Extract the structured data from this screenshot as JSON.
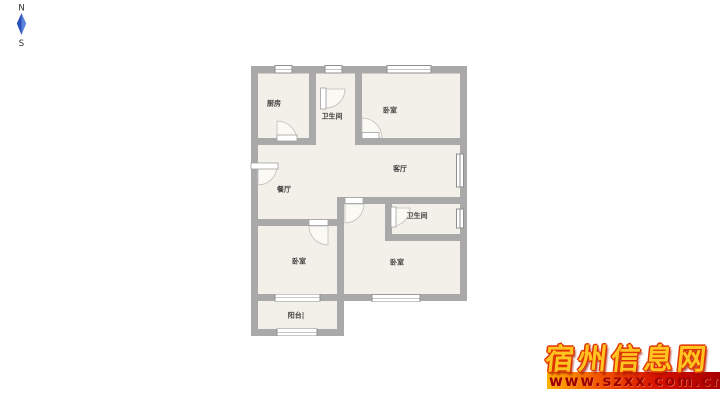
{
  "compass": {
    "north_label": "N",
    "south_label": "S"
  },
  "floor_plan": {
    "rooms": [
      {
        "id": "kitchen",
        "label": "厨房"
      },
      {
        "id": "bathroom-top",
        "label": "卫生间"
      },
      {
        "id": "bedroom-top",
        "label": "卧室"
      },
      {
        "id": "dining-room",
        "label": "餐厅"
      },
      {
        "id": "living-room",
        "label": "客厅"
      },
      {
        "id": "bathroom-right",
        "label": "卫生间"
      },
      {
        "id": "bedroom-left",
        "label": "卧室"
      },
      {
        "id": "bedroom-right",
        "label": "卧室"
      },
      {
        "id": "balcony",
        "label": "阳台|"
      }
    ],
    "colors": {
      "wall": "#a9a9a9",
      "floor": "#f2f0e9",
      "compass_needle": "#3b67cd"
    }
  },
  "watermark": {
    "site_name": "宿州信息网",
    "site_url": "www.szxx.com.cn",
    "accent_yellow": "#ffc421",
    "accent_red": "#d41000"
  }
}
